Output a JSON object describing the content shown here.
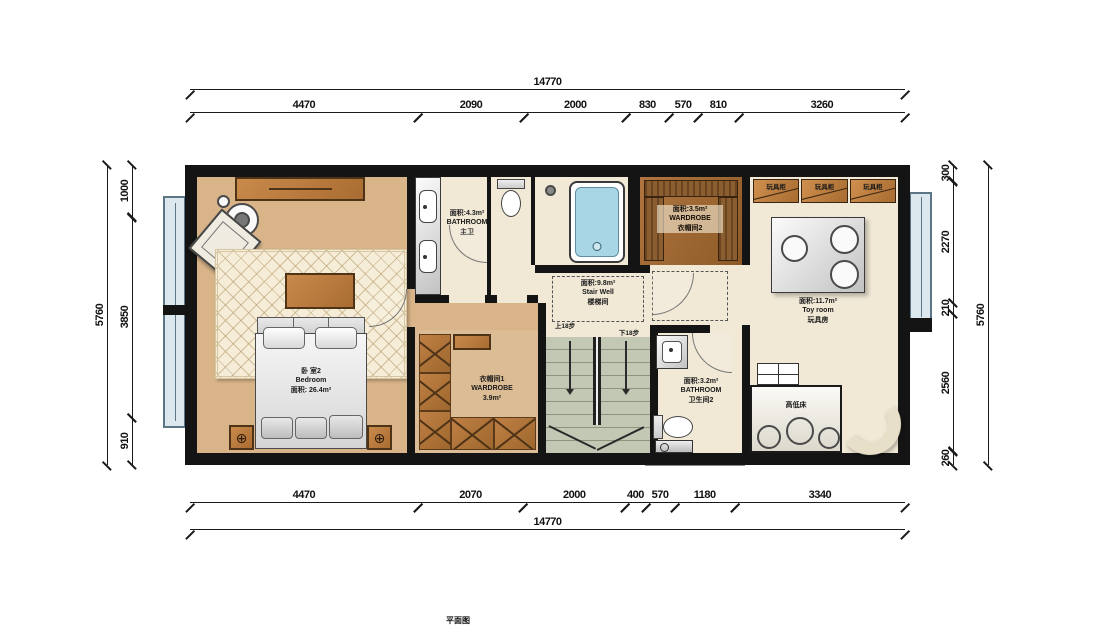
{
  "plan": {
    "caption": "平面图",
    "dimensions": {
      "top": {
        "overall": "14770",
        "segments": [
          "4470",
          "2090",
          "2000",
          "830",
          "570",
          "810",
          "3260"
        ]
      },
      "bottom": {
        "overall": "14770",
        "segments": [
          "4470",
          "2070",
          "2000",
          "400",
          "570",
          "1180",
          "3340"
        ]
      },
      "left": {
        "overall": "5760",
        "segments": [
          "1000",
          "3850",
          "910"
        ]
      },
      "right": {
        "overall": "5760",
        "segments": [
          "300",
          "2270",
          "210",
          "2560",
          "260"
        ]
      }
    },
    "rooms": {
      "bedroom": {
        "cn": "卧 室2",
        "en": "Bedroom",
        "area": "面积: 26.4m²"
      },
      "master_bath": {
        "area": "面积:4.3m²",
        "en": "BATHROOM",
        "cn": "主卫"
      },
      "stairwell": {
        "area": "面积:9.8m²",
        "en": "Stair Well",
        "cn": "楼梯间",
        "up": "上18步",
        "down": "下18步"
      },
      "wardrobe1": {
        "cn": "衣帽间1",
        "en": "WARDROBE",
        "area": "3.9m²"
      },
      "wardrobe2": {
        "area": "面积:3.5m²",
        "en": "WARDROBE",
        "cn": "衣帽间2"
      },
      "bathroom2": {
        "area": "面积:3.2m²",
        "en": "BATHROOM",
        "cn": "卫生间2"
      },
      "toy_room": {
        "area": "面积:11.7m²",
        "en": "Toy room",
        "cn": "玩具房"
      },
      "toy_cabinets": [
        "玩具柜",
        "玩具柜",
        "玩具柜"
      ],
      "bunk_bed": "高低床"
    },
    "colors": {
      "wall": "#141414",
      "wood_floor": "#d8b488",
      "cream_floor": "#f1e9d6",
      "wood_furniture": "#b97c3e",
      "tub_blue": "#a9d6e5",
      "stair_green": "#c2c8b4"
    }
  }
}
